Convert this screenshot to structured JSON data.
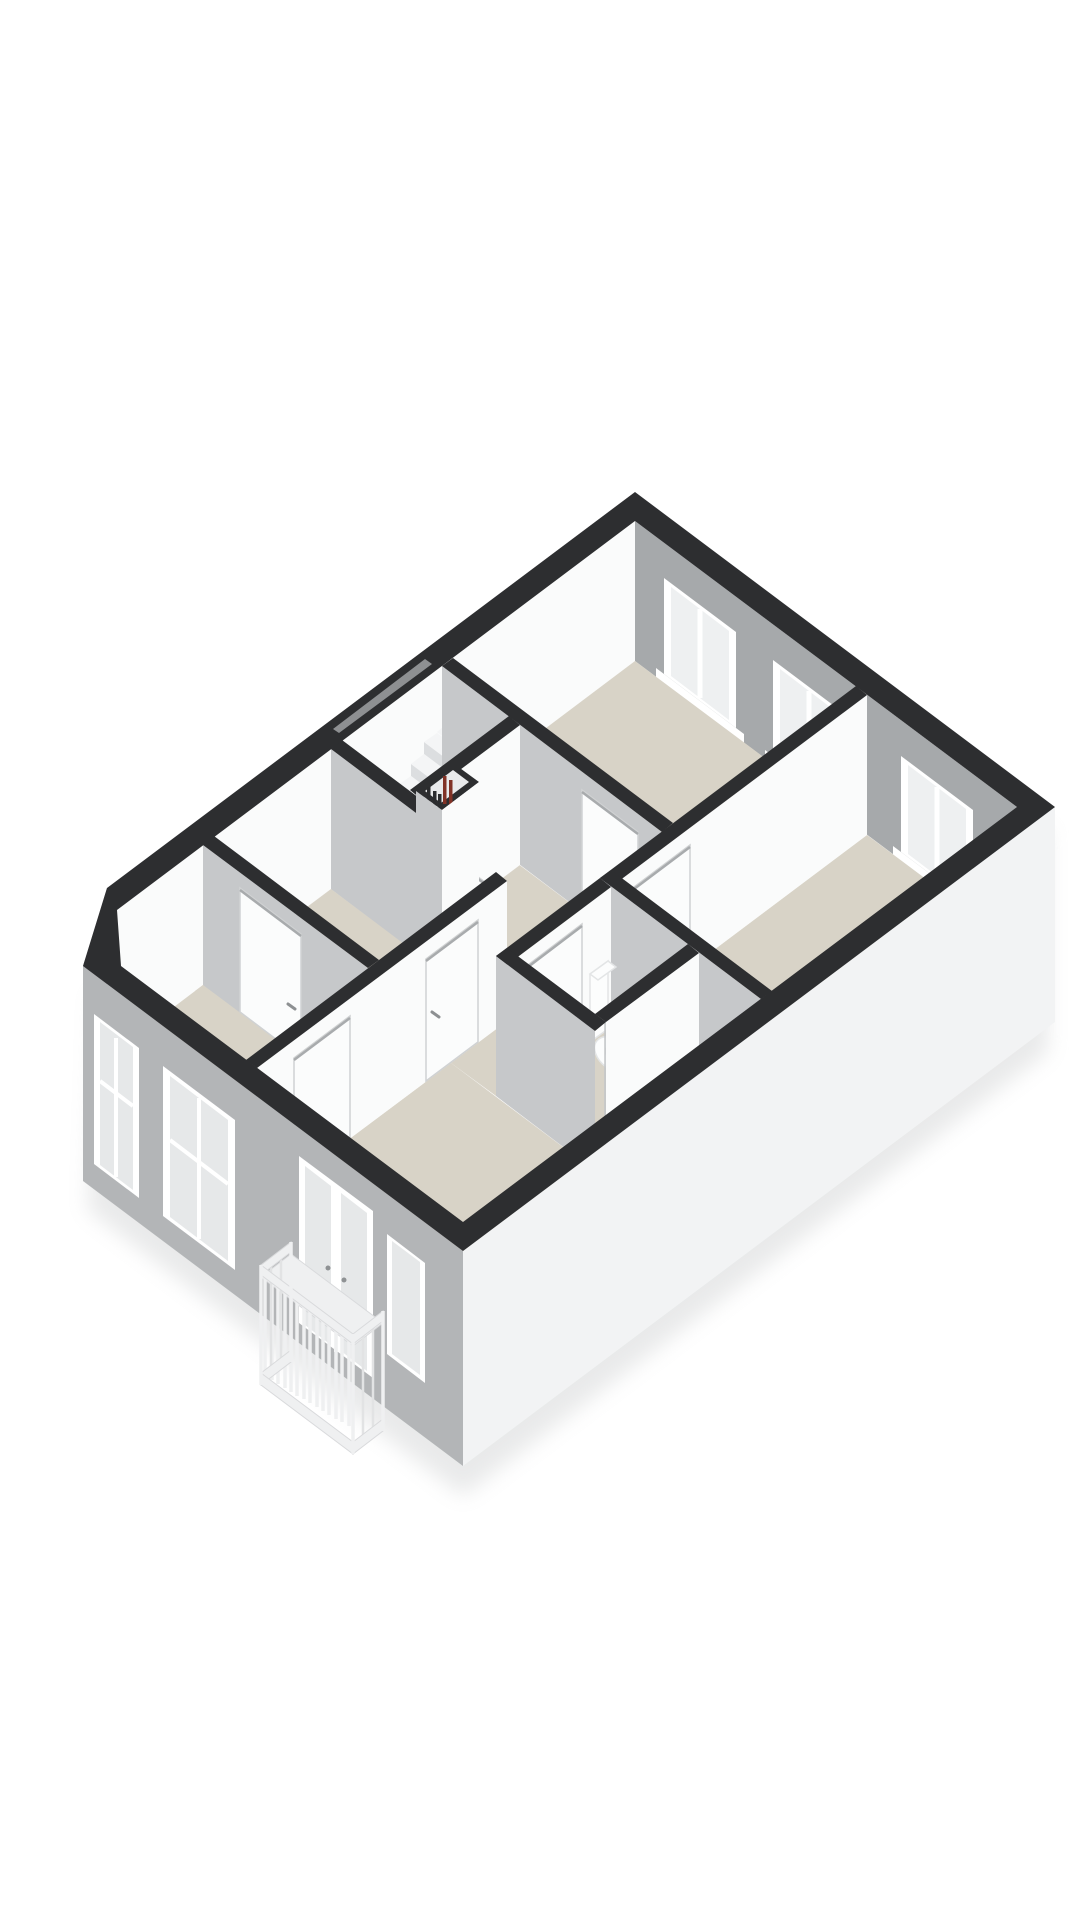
{
  "meta": {
    "title": "3D floor plan render – upper floor",
    "type": "floorplan-3d-render",
    "view": "axonometric-top"
  },
  "palette": {
    "background": "#ffffff",
    "wall_cap": "#2d2e30",
    "wall_bright": "#fafbfb",
    "wall_shaded": "#c6c8ca",
    "wall_exterior_inner": "#a6a9ab",
    "wall_exterior_outer": "#b3b5b7",
    "wall_exterior_light": "#f2f3f4",
    "floor": "#d8d3c7",
    "floor_void": "#bfc1c2",
    "glass": "#eef0f1",
    "glass_exterior": "#e6e8e9",
    "frame_white": "#ffffff",
    "stair_tread": "#f4f5f6",
    "stair_riser": "#dcdee0",
    "door_panel": "#fbfcfc",
    "handle_gray": "#8d9092",
    "fixture_white": "#fcfdfd",
    "fixture_shadow": "#e3e5e6",
    "pipe_red": "#813226",
    "pipe_black": "#2b2c2e",
    "railing": "#eff0f1",
    "contact_shadow": "#cfd0d1"
  },
  "scene": {
    "rooms": [
      {
        "id": "room-top",
        "floor": "beige",
        "windows": 2
      },
      {
        "id": "room-right",
        "floor": "beige",
        "windows": 1
      },
      {
        "id": "hall-landing",
        "floor": "beige",
        "features": [
          "staircase",
          "pipe-shaft"
        ]
      },
      {
        "id": "room-left",
        "floor": "beige",
        "windows": 0
      },
      {
        "id": "bathroom",
        "floor": "beige",
        "fixtures": [
          "toilet",
          "washbasin",
          "shower-screen"
        ]
      },
      {
        "id": "room-bottom-left",
        "floor": "beige"
      },
      {
        "id": "room-bottom-right",
        "floor": "beige"
      }
    ],
    "exterior": {
      "ne_wall_windows": 3,
      "sw_wall_windows": 2,
      "sw_small_window": 1,
      "french_balcony": {
        "doors": 2,
        "railing": "vertical-slats"
      },
      "chamfered_corner": true
    },
    "interior_doors": 6,
    "stairs": {
      "steps_visible": 7,
      "landing": true
    }
  }
}
